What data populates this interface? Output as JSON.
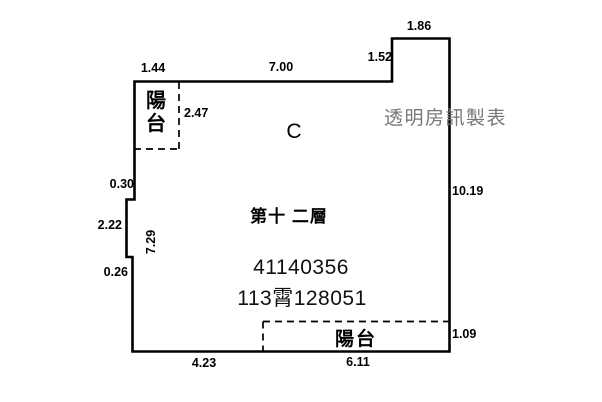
{
  "plan": {
    "watermark": "透明房訊製表",
    "unit_label": "C",
    "floor_label": "第十 二層",
    "serial_line1": "41140356",
    "serial_line2": "113霄128051"
  },
  "balconies": {
    "top_left_label": "陽台",
    "bottom_label": "陽台"
  },
  "dimensions": {
    "top_balcony_width": "1.44",
    "top_wall_width": "7.00",
    "notch_width": "1.86",
    "notch_height": "1.52",
    "top_balcony_depth": "2.47",
    "left_step_upper": "0.30",
    "right_wall_height": "10.19",
    "left_step_mid": "2.22",
    "left_wall_height": "7.29",
    "left_step_lower": "0.26",
    "bottom_wall_width": "4.23",
    "bottom_balcony_width": "6.11",
    "bottom_balcony_depth": "1.09"
  },
  "colors": {
    "background": "#ffffff",
    "wall": "#000000",
    "text": "#000000",
    "watermark": "#777777",
    "serial": "#111111"
  }
}
